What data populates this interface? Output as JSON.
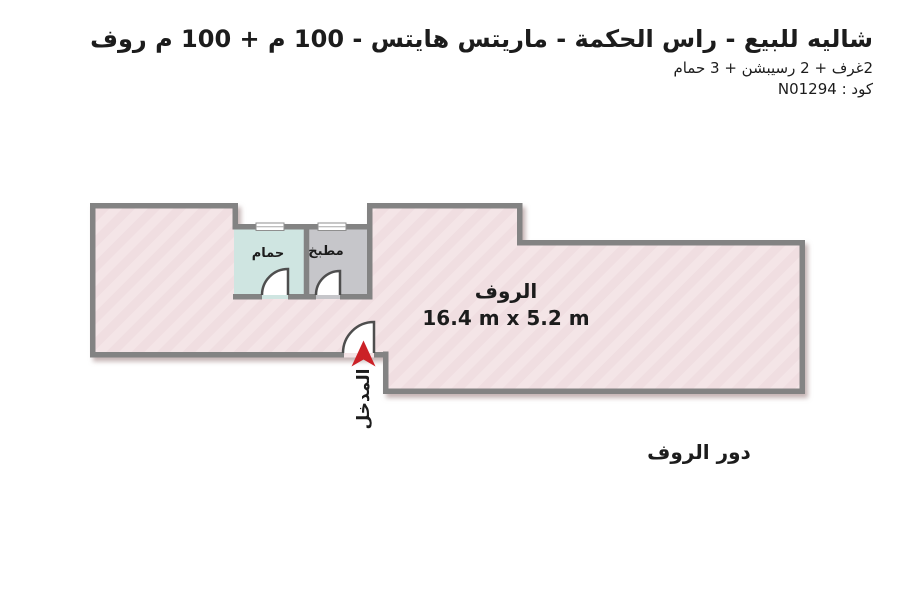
{
  "header": {
    "title": "شاليه للبيع - راس الحكمة - ماريتس هايتس - 100 م + 100 م روف",
    "subtitle": "2غرف + 2 رسيبشن + 3 حمام",
    "code_line": "كود : N01294"
  },
  "floor_plan": {
    "rooms": {
      "roof": {
        "label": "الروف",
        "dimensions": "16.4 m x 5.2 m"
      },
      "bathroom": {
        "label": "حمام"
      },
      "kitchen": {
        "label": "مطبخ"
      }
    },
    "entrance": {
      "label": "المدخل"
    },
    "floor_label": "دور الروف"
  },
  "colors": {
    "floor_fill": "#f4e5e7",
    "floor_fill_alt": "#f0dee1",
    "bathroom_fill": "#cfe5e1",
    "kitchen_fill": "#c6c6ca",
    "wall": "#838383",
    "arrow_red": "#cb2127",
    "text": "#1c1c1c"
  }
}
